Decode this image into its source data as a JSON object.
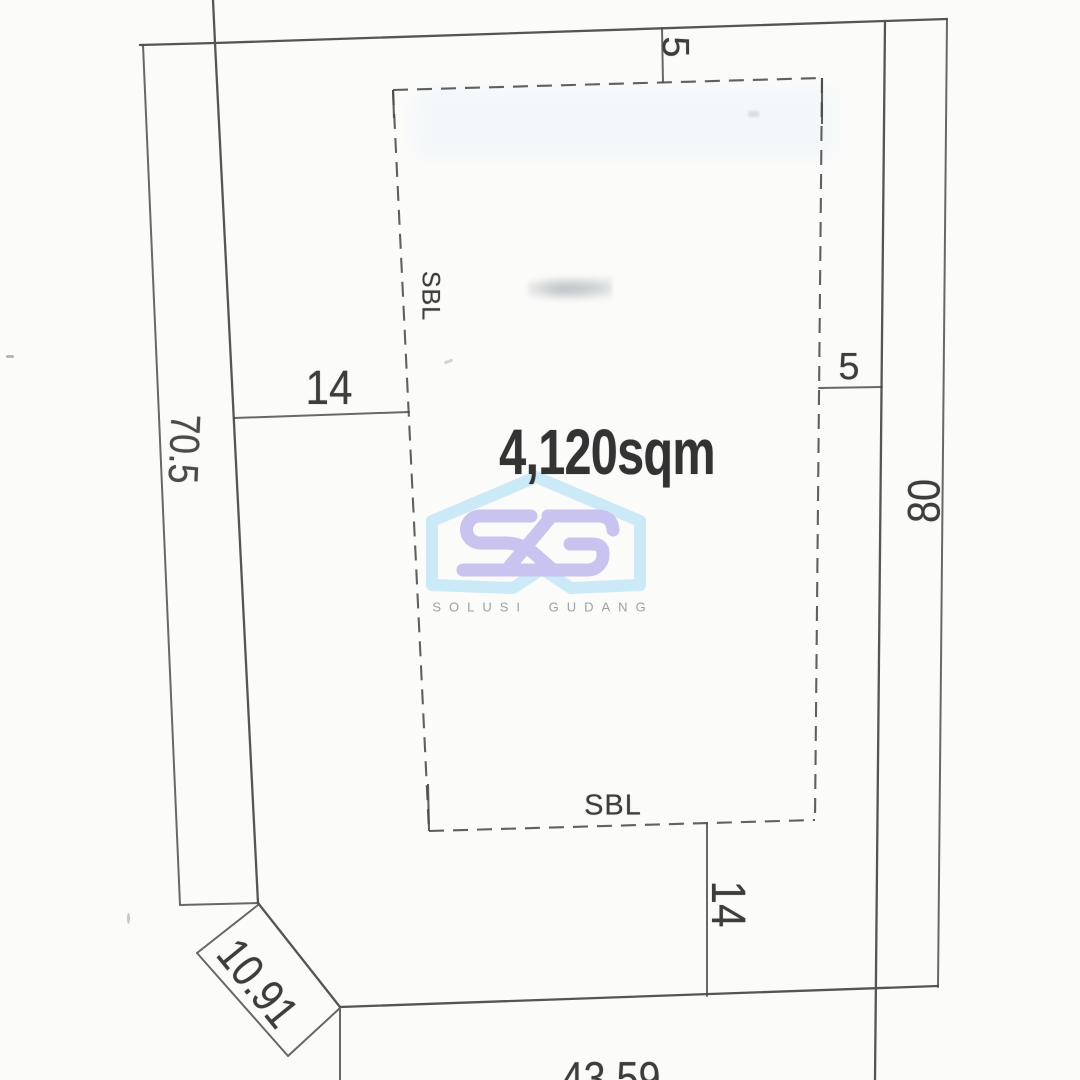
{
  "page": {
    "background_color": "#fbfbf9",
    "line_color": "#474747",
    "dashed_line_color": "#4a4a4a"
  },
  "diagram": {
    "type": "land-plot-survey",
    "area_label": "4,120sqm",
    "setback": {
      "left_label": "SBL",
      "bottom_label": "SBL"
    },
    "dimensions": {
      "top_setback_offset": "5",
      "right_setback_offset": "5",
      "left_setback_offset": "14",
      "bottom_setback_offset": "14",
      "right_boundary_length": "80",
      "left_boundary_length": "70.5",
      "corner_cut_length": "10.91",
      "bottom_boundary_length": "43.59"
    }
  },
  "watermark": {
    "monogram": "SG",
    "brand_text": "SOLUSI GUDANG",
    "colors": {
      "house_outline": "#cbe9f6",
      "monogram": "#c9c3f0",
      "brand_text": "#9ba1a8"
    }
  }
}
